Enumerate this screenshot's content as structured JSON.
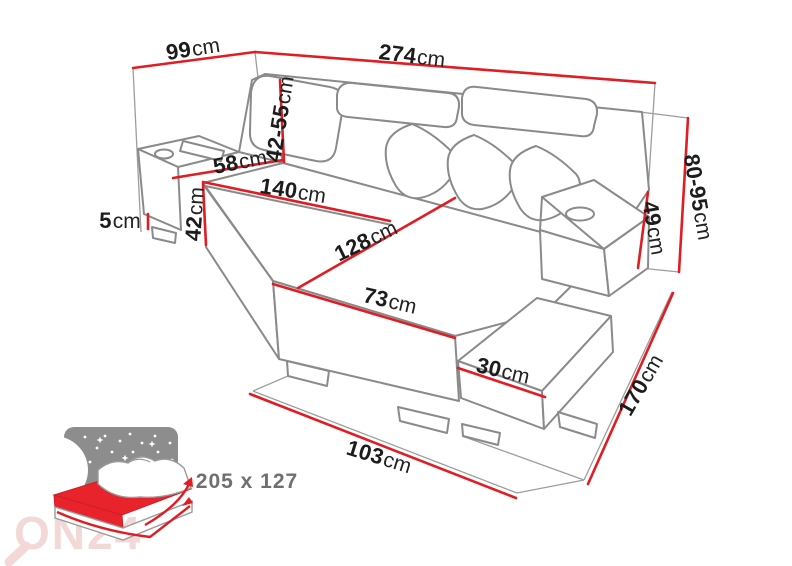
{
  "diagram": {
    "title_hint": "corner-sofa-dimension-diagram",
    "dimensions": {
      "d99": {
        "value": "99",
        "unit": "cm"
      },
      "d274": {
        "value": "274",
        "unit": "cm"
      },
      "d80_95": {
        "value": "80-95",
        "unit": "cm"
      },
      "d49": {
        "value": "49",
        "unit": "cm"
      },
      "d42_55": {
        "value": "42-55",
        "unit": "cm"
      },
      "d58": {
        "value": "58",
        "unit": "cm"
      },
      "d140": {
        "value": "140",
        "unit": "cm"
      },
      "d128": {
        "value": "128",
        "unit": "cm"
      },
      "d73": {
        "value": "73",
        "unit": "cm"
      },
      "d42": {
        "value": "42",
        "unit": "cm"
      },
      "d5": {
        "value": "5",
        "unit": "cm"
      },
      "d30": {
        "value": "30",
        "unit": "cm"
      },
      "d103": {
        "value": "103",
        "unit": "cm"
      },
      "d170": {
        "value": "170",
        "unit": "cm"
      }
    },
    "sleeping_area": {
      "label": "205 x 127"
    },
    "watermark": {
      "text": "ON24"
    },
    "colors": {
      "dimension_red": "#e11d23",
      "outline_gray": "#8a8a8a",
      "guide_gray": "#9d9d9d",
      "text_dark": "#1c1c1c",
      "note_gray": "#6f6f6f",
      "bed_panel_gray": "#8d8d8d",
      "bed_red": "#e8232b",
      "bed_red_dark": "#cf1f25",
      "watermark_pink": "#f2d2d2"
    }
  }
}
